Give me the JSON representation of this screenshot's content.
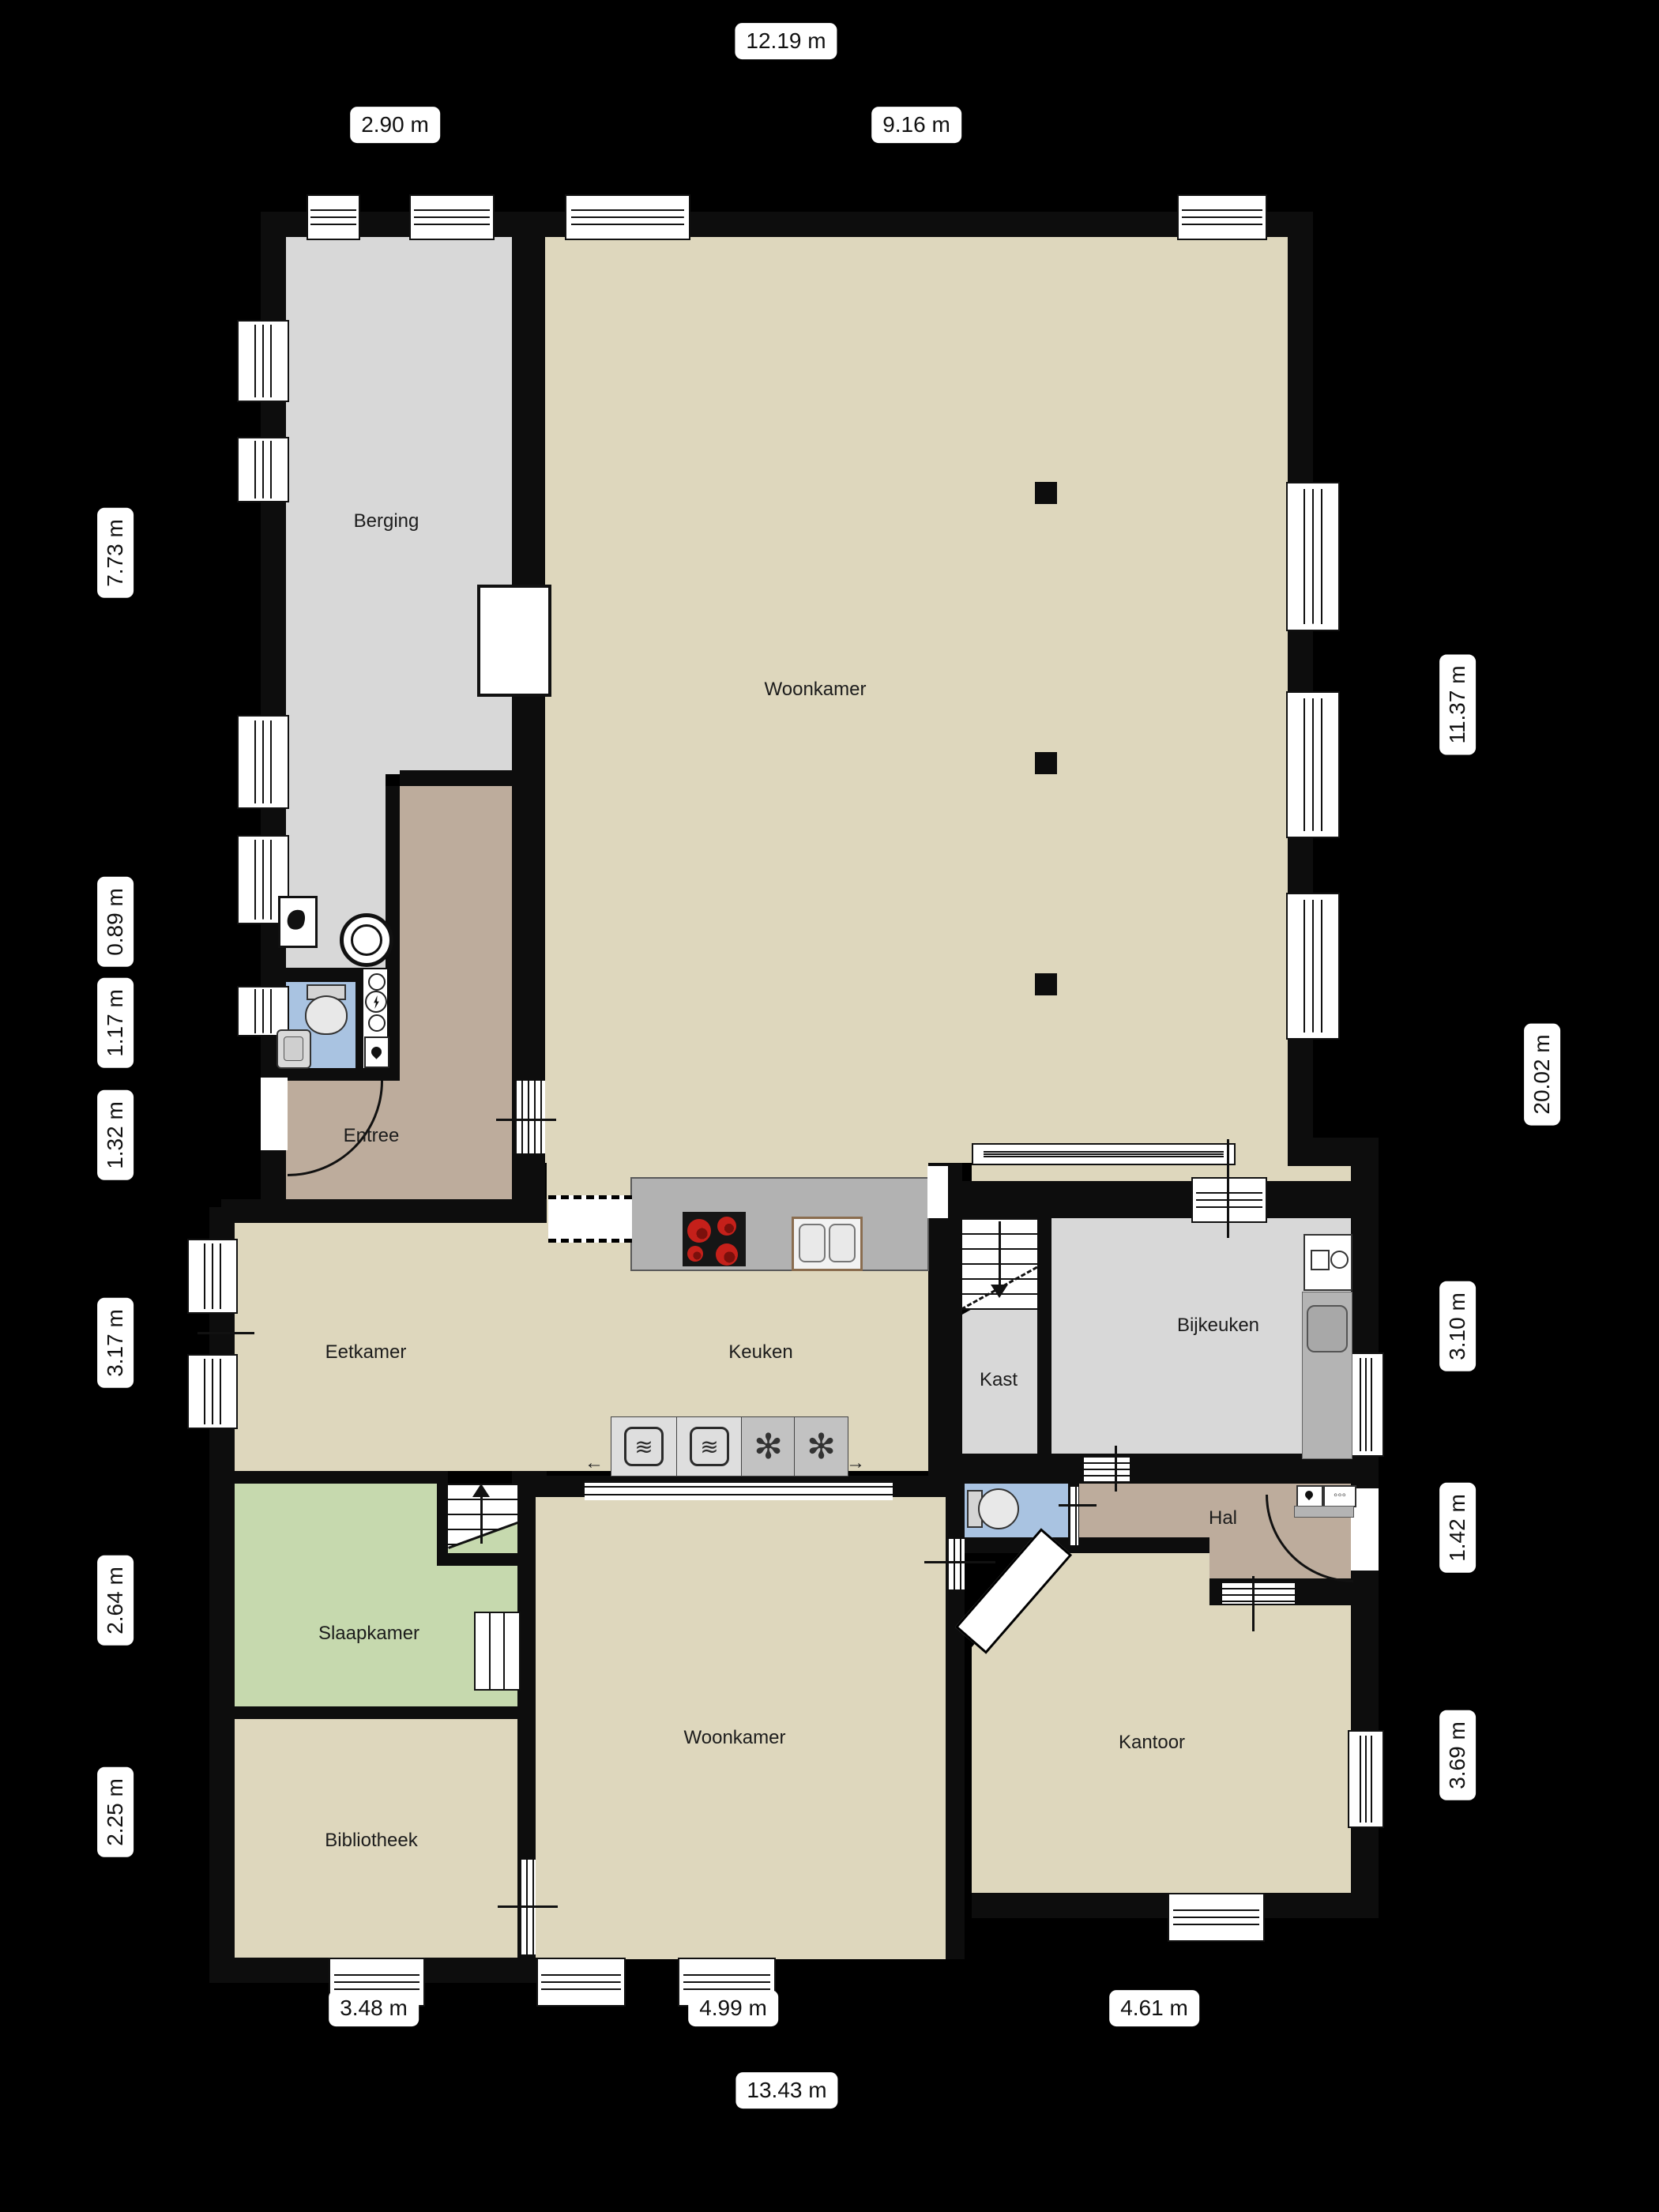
{
  "floorplan": {
    "rooms": [
      {
        "label": "Berging"
      },
      {
        "label": "Woonkamer"
      },
      {
        "label": "Entree"
      },
      {
        "label": "Eetkamer"
      },
      {
        "label": "Keuken"
      },
      {
        "label": "Kast"
      },
      {
        "label": "Bijkeuken"
      },
      {
        "label": "Slaapkamer"
      },
      {
        "label": "Hal"
      },
      {
        "label": "Woonkamer"
      },
      {
        "label": "Kantoor"
      },
      {
        "label": "Bibliotheek"
      }
    ],
    "dimensions": {
      "top": [
        "12.19 m",
        "2.90 m",
        "9.16 m"
      ],
      "left": [
        "7.73 m",
        "0.89 m",
        "1.17 m",
        "1.32 m",
        "3.17 m",
        "2.64 m",
        "2.25 m"
      ],
      "right": [
        "11.37 m",
        "20.02 m",
        "3.10 m",
        "1.42 m",
        "3.69 m"
      ],
      "bottom": [
        "3.48 m",
        "4.99 m",
        "4.61 m",
        "13.43 m"
      ]
    },
    "icons": {
      "slide_left": "←",
      "slide_right": "→",
      "oven": "≋",
      "freezer": "✻",
      "dots": "◦◦◦"
    },
    "colors": {
      "background": "#000000",
      "floor_beige": "#ded7bd",
      "floor_gray": "#d8d8d8",
      "floor_tan": "#bdac9c",
      "floor_green": "#c6d9ae",
      "floor_blue": "#a9c3e1",
      "counter_gray": "#b2b2b2",
      "wall_black": "#0d0d0d",
      "burner_red": "#c5201a"
    }
  }
}
